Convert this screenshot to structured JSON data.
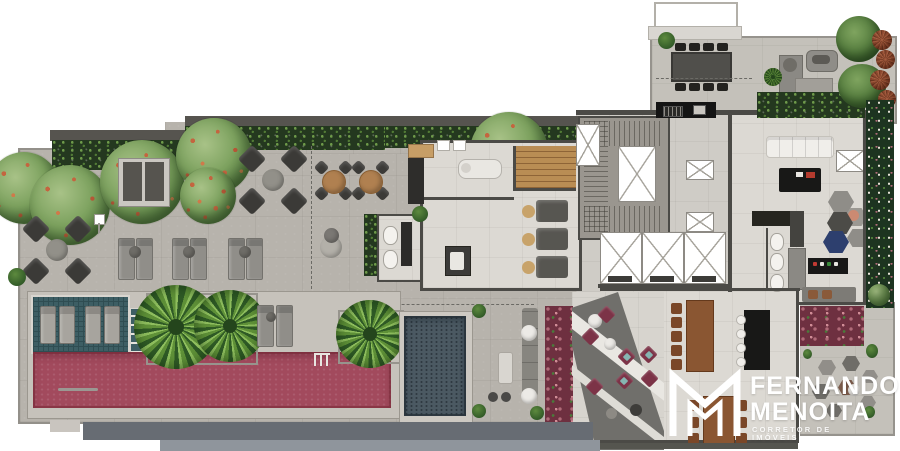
{
  "brand": {
    "name_line1": "FERNANDO",
    "name_line2": "MENOITA",
    "tagline": "CORRETOR DE IMÓVEIS"
  },
  "palette": {
    "deck": "#b7b3ac",
    "floor": "#dcd9d3",
    "terrace": "#c4c1ba",
    "wall": "#4b4a46",
    "wall_mid": "#8e8b85",
    "hedge": "#24381f",
    "hedge_dot": "#6e9a4a",
    "east_green": "#1d3420",
    "flower": "#6e3040",
    "flower_dot": "#b06a78",
    "tree": "#7da25f",
    "tree_dark": "#3f6332",
    "bloom": "#c4653f",
    "palm": "#5f9138",
    "palm_dark": "#2f5a26",
    "pool": "#a24a5d",
    "plunge": "#4b5962",
    "wet_deck": "#3d5e64",
    "wet_line": "#2f4d52",
    "dark_deck": "#706f6b",
    "wood": "#8a5632",
    "wood_chair": "#7a4728",
    "wood_light": "#b08050",
    "black_furn": "#181817",
    "gray_furn": "#8f8d88",
    "dark_furn": "#3b3a37",
    "burgundy_chair": "#7c3347",
    "teal_accent": "#86b5b1",
    "navy": "#2d3f6e",
    "salmon": "#cc8a72",
    "rust": "#8f4a30",
    "fascia": "#676c73",
    "fascia2": "#8f959c",
    "logo": "#ffffff"
  }
}
